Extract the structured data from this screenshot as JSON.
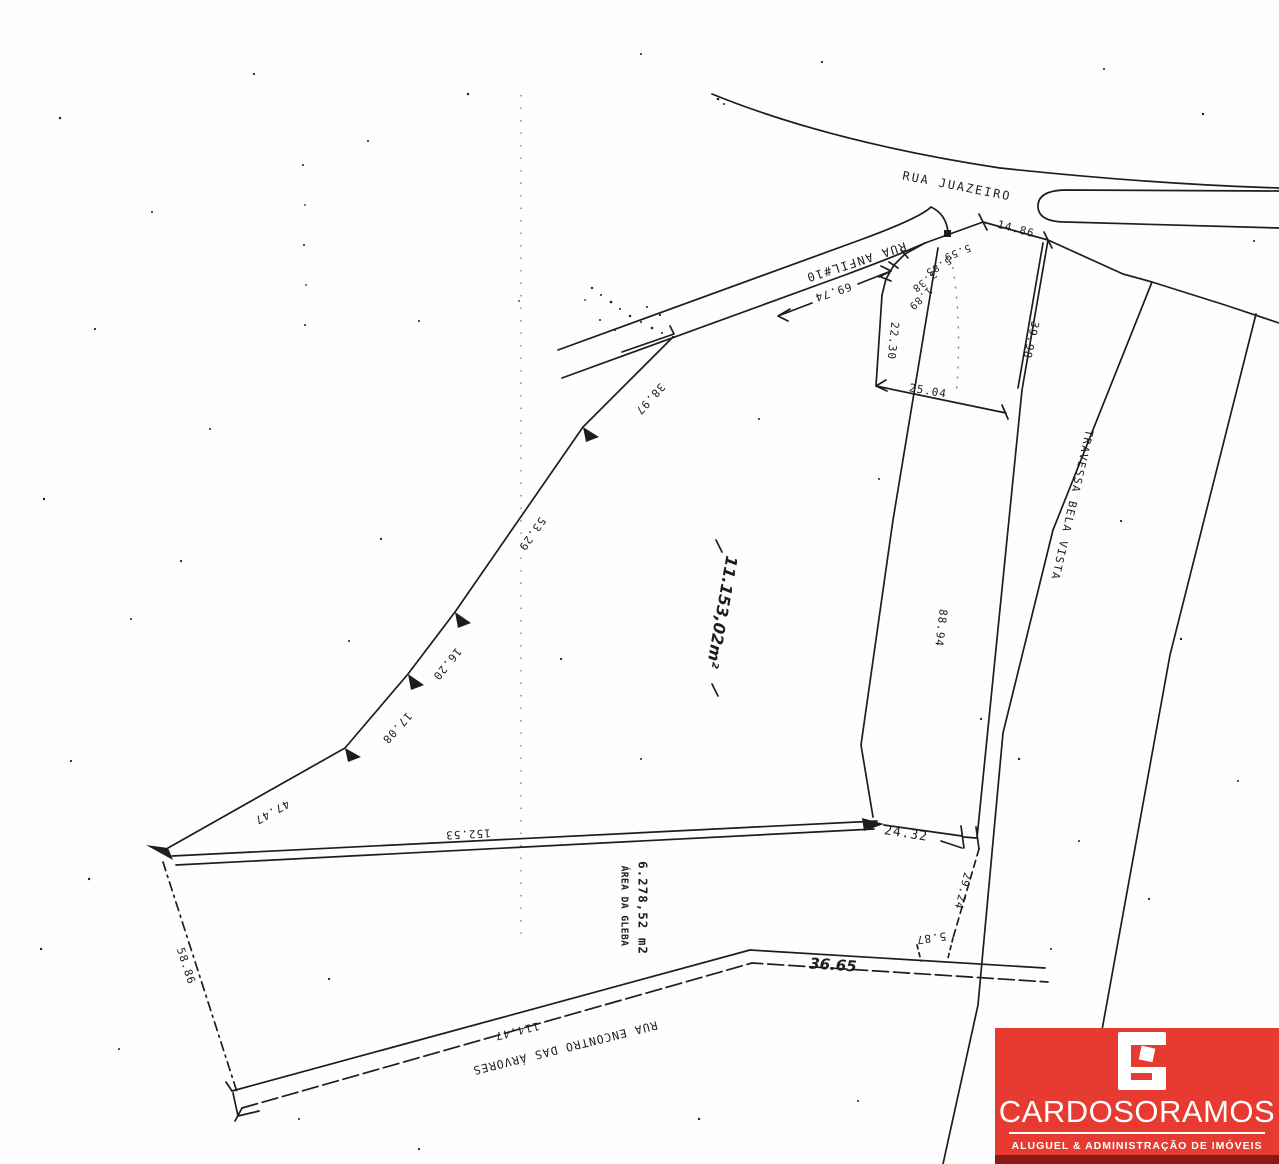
{
  "streets": {
    "juazeiro": "RUA JUAZEIRO",
    "anfil": "RUA ANFIL#10",
    "travessa": "TRAVESSA BELA VISTA",
    "encontro": "RUA ENCONTRO DAS ÁRVORES"
  },
  "areas": {
    "main_parcel_area": "11.153,02m²",
    "gleba_title": "ÁREA DA GLEBA",
    "gleba_area": "6.278,52 m2"
  },
  "dimensions": {
    "frontage_top": "14.86",
    "corner_seg_1": "5.59",
    "corner_seg_2": "5.85",
    "corner_seg_3": "3.38",
    "corner_seg_4": "1.89",
    "small_parcel_left": "22.30",
    "small_parcel_bottom": "25.04",
    "strip_upper": "39.98",
    "strip_lower": "88.94",
    "anfil_frontage": "69.74",
    "west_seg_1": "38.97",
    "west_seg_2": "53.29",
    "west_seg_3": "16.20",
    "west_seg_4": "17.08",
    "west_seg_5": "47.47",
    "south_boundary": "152.53",
    "southwest_diagonal": "58.86",
    "southeast_top": "24.32",
    "southeast_side": "29.24",
    "southeast_jog": "5.87",
    "bottom_edge": "36.65",
    "bottom_road": "114.47"
  },
  "logo": {
    "brand": "CARDOSORAMOS",
    "tagline": "ALUGUEL & ADMINISTRAÇÃO DE IMÓVEIS"
  },
  "colors": {
    "logo_red": "#e73b31",
    "logo_dark_red": "#8a1911",
    "ink": "#1d1d1b"
  }
}
